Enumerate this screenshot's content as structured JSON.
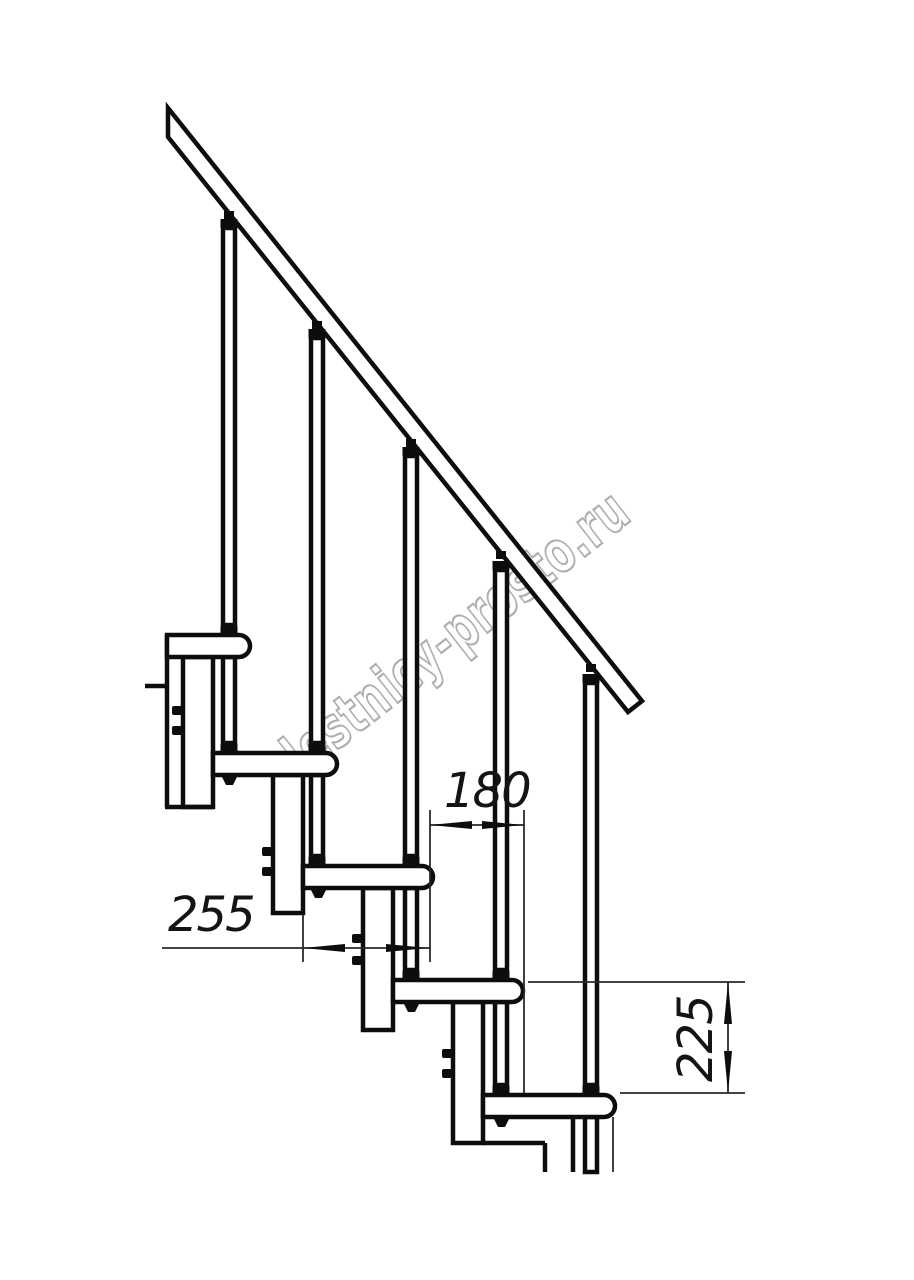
{
  "drawing": {
    "title": "modular staircase side-section technical drawing",
    "watermark": "lestnicy-prosto.ru",
    "dimensions": {
      "step_depth": "255",
      "going": "180",
      "rise": "225"
    },
    "components": {
      "treads": 5,
      "balusters": 5,
      "handrail": "inclined handrail band, slope rise 225 / going 180"
    },
    "colors": {
      "line": "#0d0d0d",
      "watermark_outline": "#aeaeae",
      "background": "#ffffff"
    }
  }
}
